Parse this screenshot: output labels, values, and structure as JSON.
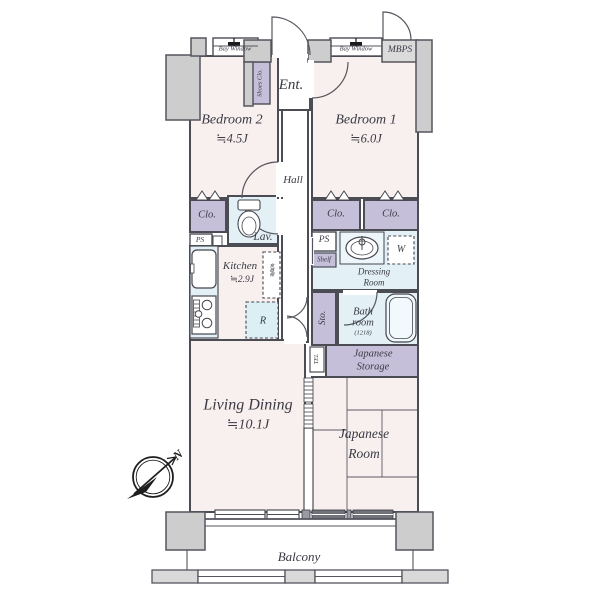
{
  "plan": {
    "labels": {
      "bay_window_left": "Bay Window",
      "bay_window_right": "Bay Window",
      "mbps": "MBPS",
      "entrance": "Ent.",
      "shoes_closet": "Shoes Clo.",
      "hall": "Hall",
      "bedroom2_name": "Bedroom 2",
      "bedroom2_size": "≒4.5J",
      "bedroom1_name": "Bedroom 1",
      "bedroom1_size": "≒6.0J",
      "closet_left": "Clo.",
      "ps_left": "PS",
      "lavatory": "Lav.",
      "closet_mid": "Clo.",
      "closet_right": "Clo.",
      "ps_right": "PS",
      "shelf": "Shelf",
      "washer": "W",
      "dressing_line1": "Dressing",
      "dressing_line2": "Room",
      "kitchen_name": "Kitchen",
      "kitchen_size": "≒2.9J",
      "cupboard": "食器棚",
      "fridge": "R",
      "storage_sto": "Sto.",
      "bath_line1": "Bath",
      "bath_line2": "room",
      "bath_size": "(1218)",
      "tel": "TEL",
      "jp_storage_line1": "Japanese",
      "jp_storage_line2": "Storage",
      "living_name": "Living Dining",
      "living_size": "≒10.1J",
      "jp_room_line1": "Japanese",
      "jp_room_line2": "Room",
      "balcony": "Balcony",
      "compass_north": "N"
    },
    "colors": {
      "floor_pink": "#f8f0ee",
      "wet_area_blue": "#e3f1f6",
      "storage_purple": "#c6bfd9",
      "wall_dark": "#4c4c55",
      "pillar_gray": "#cdcdce",
      "mbps_gray": "#dbdbdb",
      "text": "#3a3a45"
    }
  }
}
